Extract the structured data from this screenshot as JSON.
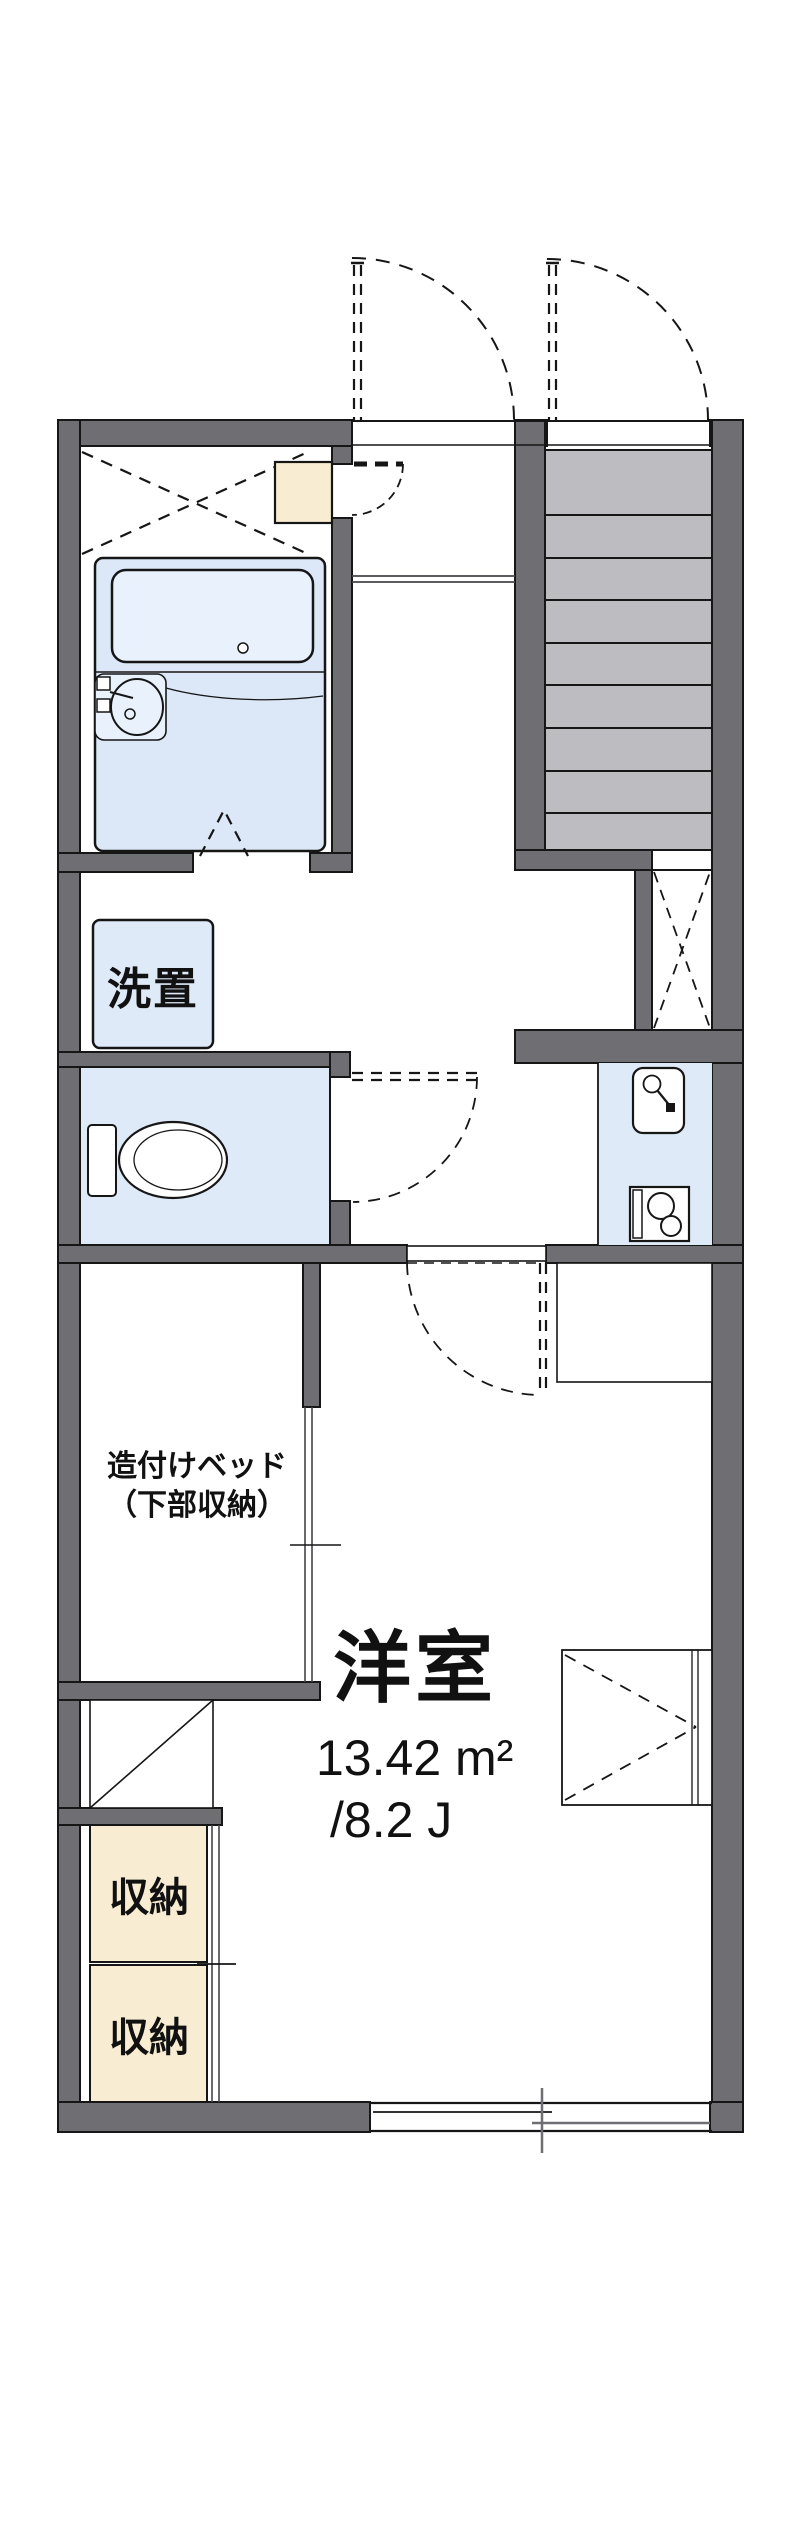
{
  "floorplan": {
    "colors": {
      "wall": "#6e6e73",
      "outline": "#161616",
      "water_area_fill": "#dfeaf8",
      "bath_unit_fill": "#dce8f7",
      "tub_fill": "#e9f2fc",
      "storage_fill": "#f8edd2",
      "stairs_fill": "#bdbdc1",
      "background": "#ffffff"
    },
    "rooms": {
      "western_room": {
        "label": "洋室",
        "area_sqm": "13.42 m²",
        "area_tatami": "/8.2 J"
      },
      "washer_space": {
        "label": "洗置"
      },
      "built_in_bed": {
        "label_line1": "造付けベッド",
        "label_line2": "（下部収納）"
      },
      "storage_upper": {
        "label": "収納"
      },
      "storage_lower": {
        "label": "収納"
      }
    }
  }
}
